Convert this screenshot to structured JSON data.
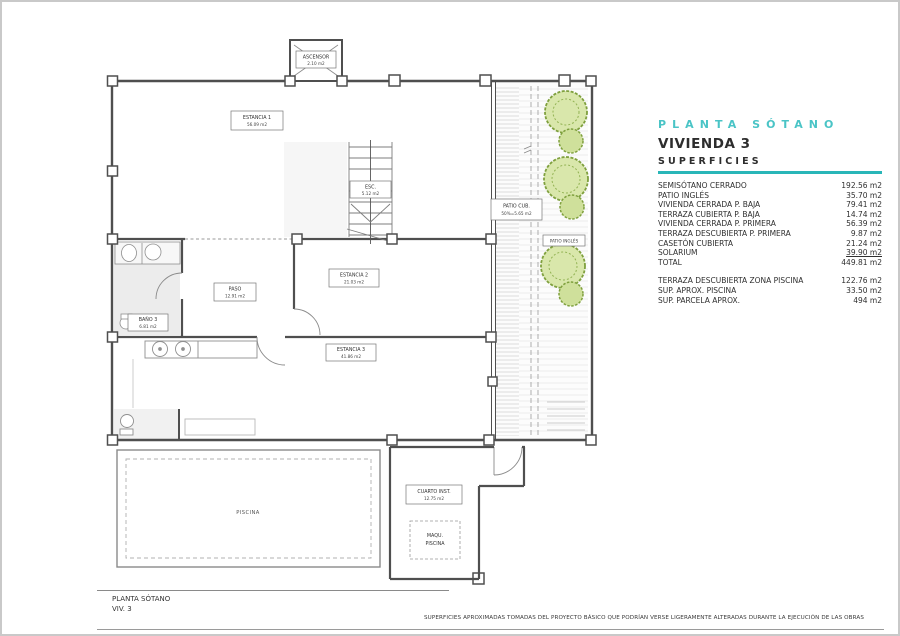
{
  "colors": {
    "teal": "#29b6b8",
    "wall": "#4f4f4f",
    "tree_green": "#7fa03e"
  },
  "panel": {
    "header": "PLANTA SÓTANO",
    "dwelling": "VIVIENDA 3",
    "section": "SUPERFICIES",
    "rows": [
      {
        "label": "SEMISÓTANO CERRADO",
        "value": "192.56 m2"
      },
      {
        "label": "PATIO INGLÉS",
        "value": "35.70 m2"
      },
      {
        "label": "VIVIENDA CERRADA P. BAJA",
        "value": "79.41 m2"
      },
      {
        "label": "TERRAZA CUBIERTA P. BAJA",
        "value": "14.74 m2"
      },
      {
        "label": "VIVIENDA CERRADA P. PRIMERA",
        "value": "56.39 m2"
      },
      {
        "label": "TERRAZA DESCUBIERTA P. PRIMERA",
        "value": "9.87 m2"
      },
      {
        "label": "CASETÓN CUBIERTA",
        "value": "21.24 m2"
      },
      {
        "label": "SOLARIUM",
        "value": "39.90 m2"
      },
      {
        "label": "TOTAL",
        "value": "449.81 m2"
      }
    ],
    "rows_extra": [
      {
        "label": "TERRAZA DESCUBIERTA  ZONA PISCINA",
        "value": "122.76 m2"
      },
      {
        "label": "SUP.  APROX.  PISCINA",
        "value": "33.50 m2"
      },
      {
        "label": "SUP. PARCELA APROX.",
        "value": "494 m2"
      }
    ]
  },
  "plan": {
    "labels": {
      "ascensor": {
        "name": "ASCENSOR",
        "area": "2.10 m2"
      },
      "estancia1": {
        "name": "ESTANCIA 1",
        "area": "56.09 m2"
      },
      "esc": {
        "name": "ESC.",
        "area": "5.12 m2"
      },
      "patio_cub": {
        "name": "PATIO CUB.",
        "area": "50%=5.65 m2"
      },
      "patio_ingles": {
        "name": "PATIO INGLÉS"
      },
      "estancia2": {
        "name": "ESTANCIA 2",
        "area": "21.03 m2"
      },
      "paso": {
        "name": "PASO",
        "area": "12.91 m2"
      },
      "bano3": {
        "name": "BAÑO 3",
        "area": "6.81 m2"
      },
      "estancia3": {
        "name": "ESTANCIA 3",
        "area": "41.86 m2"
      },
      "cuarto_inst": {
        "name": "CUARTO INST.",
        "area": "12.75 m2"
      },
      "maqu_piscina": {
        "line1": "MAQU.",
        "line2": "PISCINA"
      },
      "piscina": {
        "name": "PISCINA"
      }
    }
  },
  "titleblock": {
    "title": "PLANTA SÓTANO",
    "subtitle": "VIV. 3"
  },
  "footer": {
    "disclaimer": "SUPERFICIES APROXIMADAS TOMADAS DEL PROYECTO BÁSICO QUE PODRÍAN VERSE LIGERAMENTE ALTERADAS DURANTE LA EJECUCIÓN DE LAS OBRAS"
  }
}
